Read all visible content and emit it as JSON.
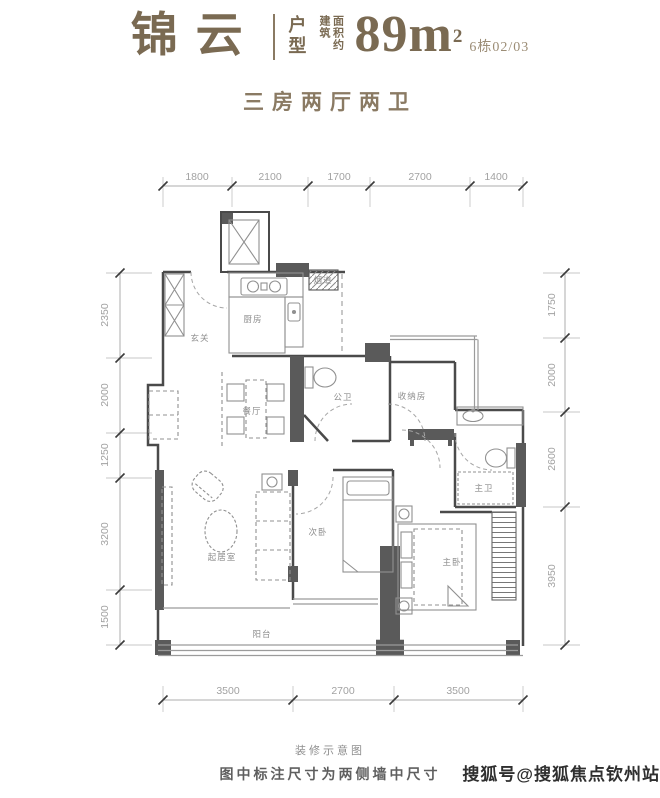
{
  "header": {
    "project_name": "锦云",
    "type_label": "户型",
    "area_prefix_col1": "建筑",
    "area_prefix_col2": "面积约",
    "area_value": "89",
    "area_unit": "m",
    "area_exponent": "2",
    "unit_no": "6栋02/03",
    "subtitle": "三房两厅两卫"
  },
  "plan": {
    "rooms": {
      "entry": "玄关",
      "kitchen": "厨房",
      "dining": "餐厅",
      "public_bath": "公卫",
      "storage": "收纳房",
      "master_bath": "主卫",
      "living": "起居室",
      "second_bedroom": "次卧",
      "master_bedroom": "主卧",
      "balcony": "阳台",
      "flue": "烟道"
    },
    "dims": {
      "top": [
        "1800",
        "2100",
        "1700",
        "2700",
        "1400"
      ],
      "left": [
        "2350",
        "2000",
        "1250",
        "3200",
        "1500"
      ],
      "right": [
        "1750",
        "2000",
        "2600",
        "3950"
      ],
      "bottom": [
        "3500",
        "2700",
        "3500"
      ]
    }
  },
  "footer": {
    "caption": "装修示意图",
    "note": "图中标注尺寸为两侧墙中尺寸",
    "watermark": "搜狐号@搜狐焦点钦州站"
  },
  "colors": {
    "title_brown": "#7a6a52",
    "subtitle_brown": "#8a7a63",
    "wall_dark": "#5a5a5a",
    "dim_grey": "#a2a2a2",
    "watermark_dark": "#2f2f2f"
  }
}
